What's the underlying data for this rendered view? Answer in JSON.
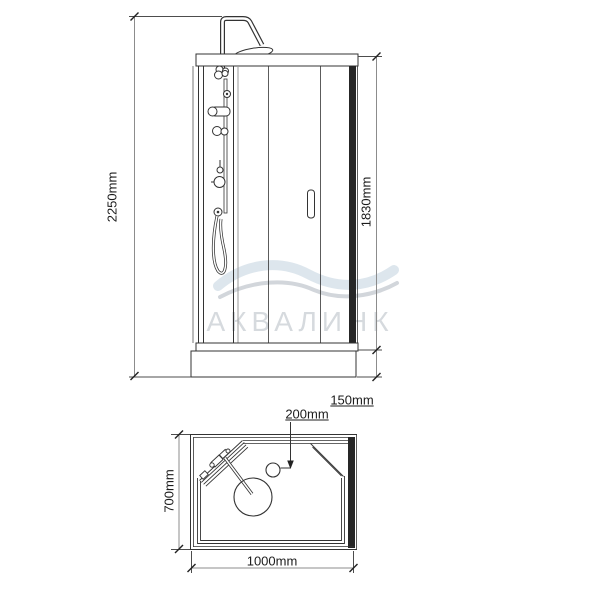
{
  "drawing": {
    "kind": "technical dimension drawing",
    "subject": "shower cabin with tray",
    "views": [
      "front elevation",
      "plan view"
    ]
  },
  "front_view": {
    "dim_total_height": "2250mm",
    "dim_cabin_height": "1830mm",
    "dim_tray_height": "150mm"
  },
  "plan_view": {
    "dim_depth": "700mm",
    "dim_width": "1000mm",
    "dim_drain_offset": "200mm"
  },
  "watermark": {
    "text": "АКВАЛИНК"
  },
  "colors": {
    "object_line": "#333333",
    "dark_frame": "#262626",
    "dimension_line": "#8c8c8c",
    "extension_line": "#4d4d4d",
    "watermark_text": "#d6dade",
    "wave_blue": "#dde6ed",
    "wave_gray": "#d2d6db",
    "background": "#ffffff"
  }
}
